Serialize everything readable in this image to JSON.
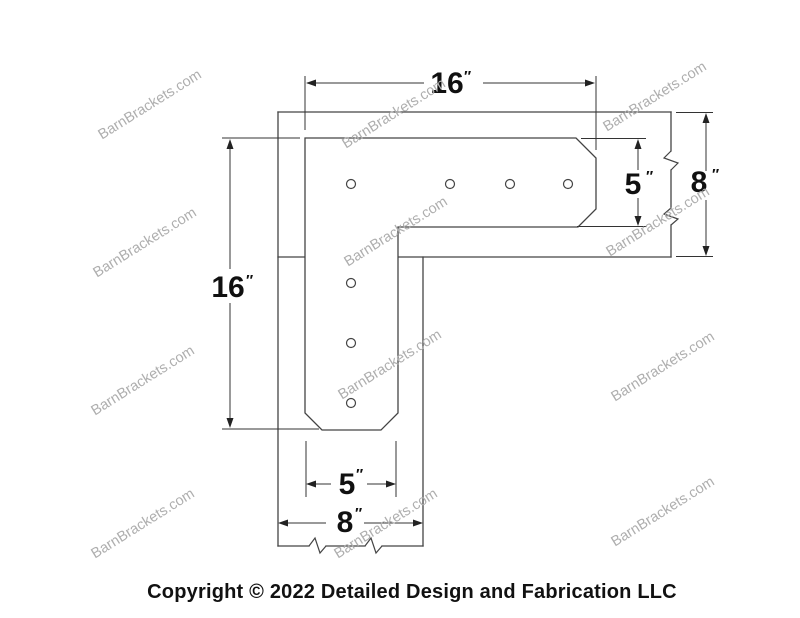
{
  "watermark": {
    "text": "BarnBrackets.com"
  },
  "footer": {
    "copyright": "Copyright © 2022 Detailed Design and Fabrication LLC"
  },
  "dimensions": {
    "top_width": {
      "value": "16",
      "unit": "″"
    },
    "left_height": {
      "value": "16",
      "unit": "″"
    },
    "right_bracket_width": {
      "value": "5",
      "unit": "″"
    },
    "right_beam_depth": {
      "value": "8",
      "unit": "″"
    },
    "bottom_bracket_width": {
      "value": "5",
      "unit": "″"
    },
    "bottom_post_width": {
      "value": "8",
      "unit": "″"
    }
  },
  "colors": {
    "line": "#444444",
    "dimension_text": "#101010",
    "watermark": "#aeaeae",
    "background": "#ffffff"
  }
}
